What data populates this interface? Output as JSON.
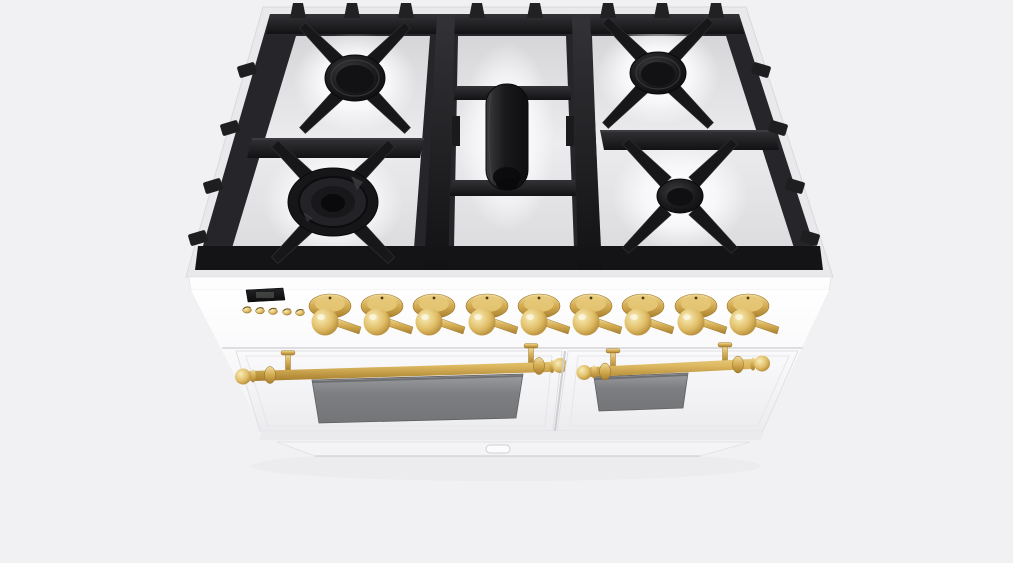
{
  "scene": {
    "description": "3D product render of a white freestanding double-oven gas range with brass trim, viewed from the front and above",
    "background_color": "#f1f1f4"
  },
  "range": {
    "body_color": "#fbfbfd",
    "brass_color": "#d9b35e",
    "cooktop": {
      "surface_color": "#232327",
      "grate_color": "#1a1a1c",
      "drip_tray_color": "#e9e9ec",
      "burner_count": 5,
      "burners": [
        {
          "name": "rear-left-burner",
          "style": "round-black-cap"
        },
        {
          "name": "front-left-burner",
          "style": "large-double-ring"
        },
        {
          "name": "center-griddle-burner",
          "style": "oval"
        },
        {
          "name": "rear-right-burner",
          "style": "round-black-cap"
        },
        {
          "name": "front-right-burner",
          "style": "round-black-cap"
        }
      ]
    },
    "control_panel": {
      "display": {
        "value": "",
        "color": "#121214"
      },
      "button_count": 5,
      "buttons": [
        {
          "name": "clock-button-1"
        },
        {
          "name": "clock-button-2"
        },
        {
          "name": "clock-button-3"
        },
        {
          "name": "clock-button-4"
        },
        {
          "name": "clock-button-5"
        }
      ],
      "knob_count": 9,
      "knobs": [
        {
          "name": "burner-knob-1"
        },
        {
          "name": "burner-knob-2"
        },
        {
          "name": "burner-knob-3"
        },
        {
          "name": "burner-knob-4"
        },
        {
          "name": "burner-knob-5"
        },
        {
          "name": "burner-knob-6"
        },
        {
          "name": "burner-knob-7"
        },
        {
          "name": "burner-knob-8"
        },
        {
          "name": "burner-knob-9"
        }
      ]
    },
    "ovens": {
      "left": {
        "name": "left-oven-door",
        "handle": "brass-rail-with-ball-finials",
        "window_color": "#7c7e81"
      },
      "right": {
        "name": "right-oven-door",
        "handle": "brass-rail-with-ball-finials",
        "window_color": "#7c7e81"
      }
    },
    "kick_panel": {
      "name": "kick-panel",
      "latch": "kick-panel-latch"
    }
  }
}
